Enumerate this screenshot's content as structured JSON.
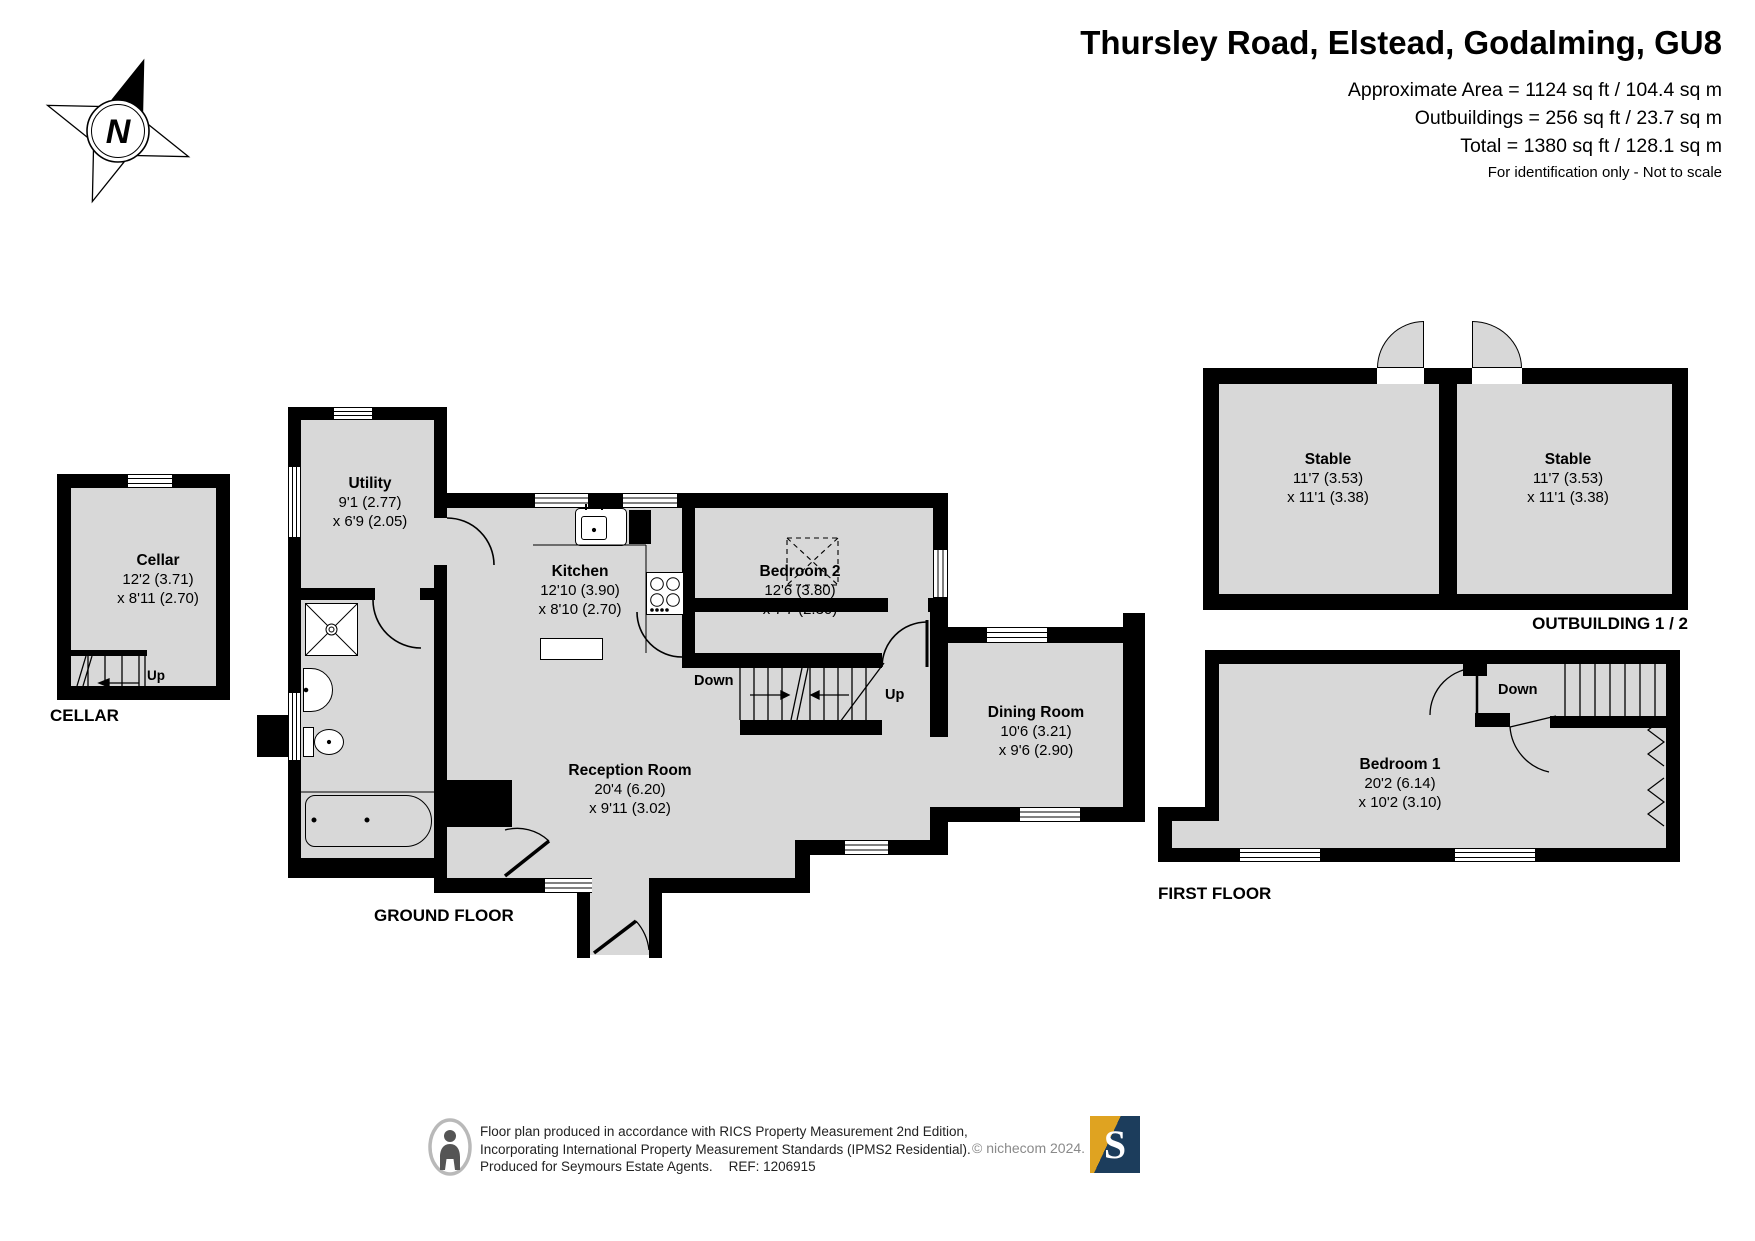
{
  "header": {
    "title": "Thursley Road, Elstead, Godalming, GU8",
    "approx_area": "Approximate Area = 1124 sq ft / 104.4 sq m",
    "outbuildings": "Outbuildings = 256 sq ft / 23.7 sq m",
    "total": "Total = 1380 sq ft / 128.1 sq m",
    "disclaimer": "For identification only - Not to scale"
  },
  "compass": {
    "north_label": "N"
  },
  "cellar": {
    "floor_label": "CELLAR",
    "room": {
      "name": "Cellar",
      "dim1": "12'2 (3.71)",
      "dim2": "x 8'11 (2.70)"
    },
    "stairs": {
      "up_label": "Up"
    }
  },
  "ground_floor": {
    "floor_label": "GROUND FLOOR",
    "rooms": {
      "utility": {
        "name": "Utility",
        "dim1": "9'1 (2.77)",
        "dim2": "x 6'9 (2.05)"
      },
      "kitchen": {
        "name": "Kitchen",
        "dim1": "12'10 (3.90)",
        "dim2": "x 8'10 (2.70)"
      },
      "bedroom2": {
        "name": "Bedroom 2",
        "dim1": "12'6 (3.80)",
        "dim2": "x 7'7 (2.30)"
      },
      "reception": {
        "name": "Reception Room",
        "dim1": "20'4 (6.20)",
        "dim2": "x 9'11 (3.02)"
      },
      "dining": {
        "name": "Dining Room",
        "dim1": "10'6 (3.21)",
        "dim2": "x 9'6 (2.90)"
      }
    },
    "stairs": {
      "down_label": "Down",
      "up_label": "Up"
    }
  },
  "first_floor": {
    "floor_label": "FIRST FLOOR",
    "rooms": {
      "bedroom1": {
        "name": "Bedroom 1",
        "dim1": "20'2 (6.14)",
        "dim2": "x 10'2 (3.10)"
      }
    },
    "stairs": {
      "down_label": "Down"
    }
  },
  "outbuilding": {
    "floor_label": "OUTBUILDING 1 / 2",
    "rooms": {
      "stable1": {
        "name": "Stable",
        "dim1": "11'7 (3.53)",
        "dim2": "x 11'1 (3.38)"
      },
      "stable2": {
        "name": "Stable",
        "dim1": "11'7 (3.53)",
        "dim2": "x 11'1 (3.38)"
      }
    }
  },
  "footer": {
    "line1": "Floor plan produced in accordance with RICS Property Measurement 2nd Edition,",
    "line2": "Incorporating International Property Measurement Standards (IPMS2 Residential).",
    "line3": "Produced for Seymours Estate Agents.",
    "ref": "REF: 1206915",
    "copyright": "© nichecom 2024.",
    "logo_letter": "S"
  },
  "colors": {
    "room_fill": "#d8d8d8",
    "wall": "#000000",
    "logo_navy": "#1c3d5c",
    "logo_gold": "#dfa321"
  }
}
